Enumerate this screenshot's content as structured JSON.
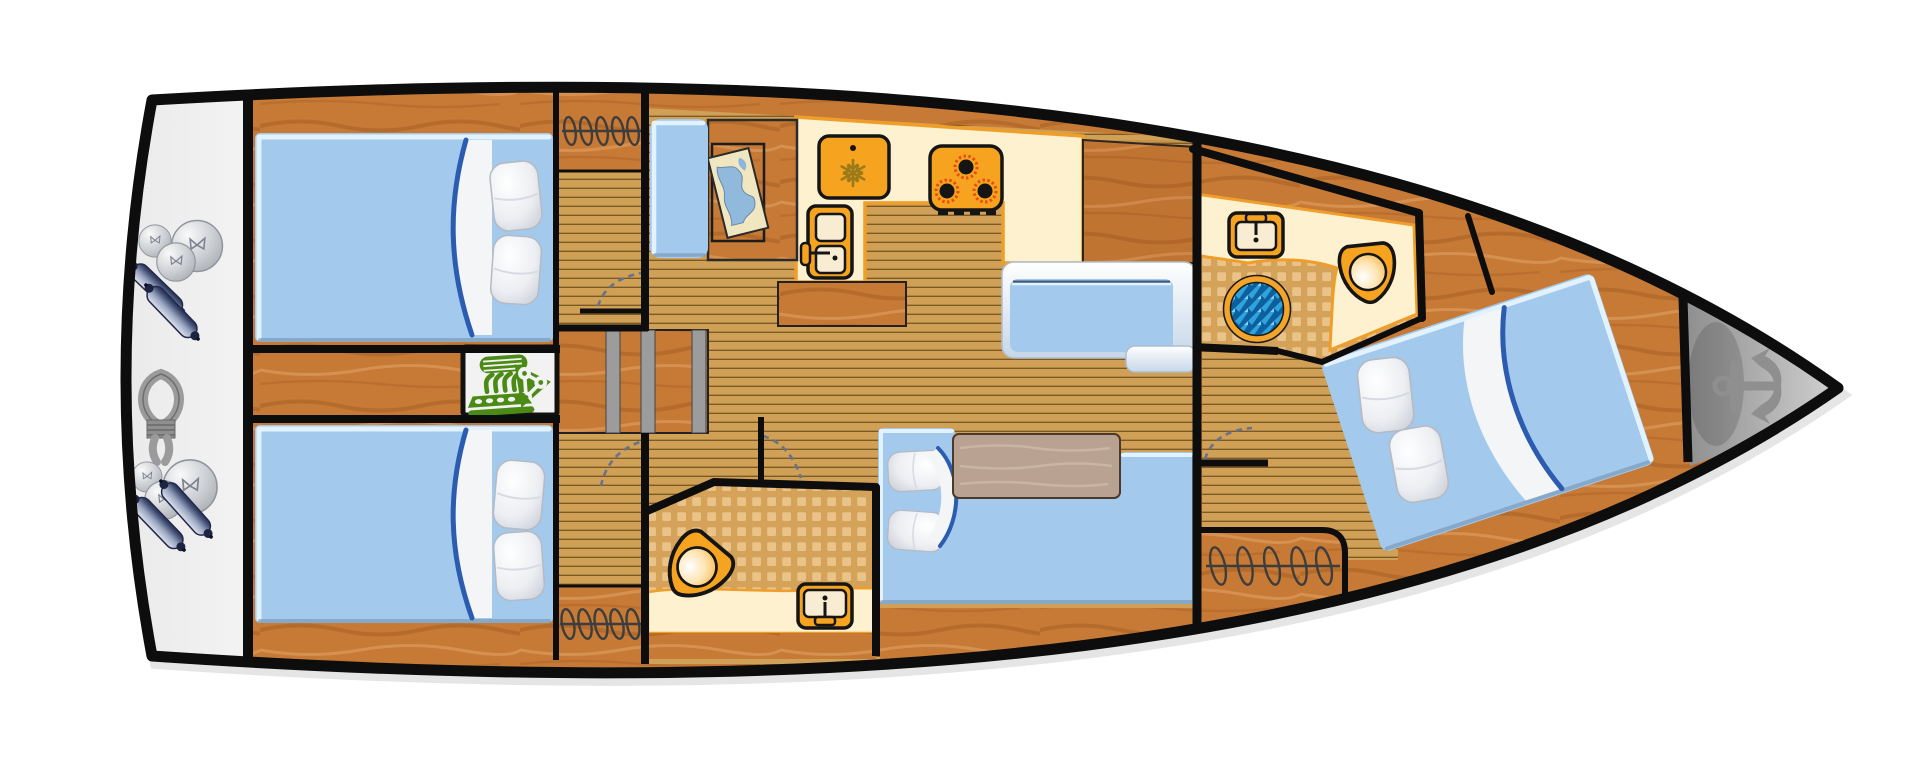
{
  "diagram": {
    "type": "yacht-interior-floor-plan",
    "title": "Sailing yacht interior layout — top-down deck plan, bow to the right",
    "orientation": "bow-right",
    "rooms": [
      {
        "id": "stern-platform",
        "label": "Stern swim platform / lazarette",
        "features": [
          "fender-balls",
          "cylindrical-fenders",
          "mooring-rope-coil"
        ]
      },
      {
        "id": "aft-cabin-port",
        "label": "Aft double cabin (top)",
        "features": [
          "double-berth",
          "two-pillows",
          "folded-blanket"
        ]
      },
      {
        "id": "aft-cabin-stbd",
        "label": "Aft double cabin (bottom)",
        "features": [
          "double-berth",
          "two-pillows",
          "folded-blanket"
        ]
      },
      {
        "id": "engine-room",
        "label": "Engine compartment between aft cabins",
        "features": [
          "engine"
        ]
      },
      {
        "id": "companionway",
        "label": "Companionway steps amidships",
        "features": [
          "three-treads"
        ]
      },
      {
        "id": "hanging-lockers",
        "label": "Hanging lockers (coil symbols)",
        "features": [
          "aft-top",
          "aft-bottom",
          "forward-cabin"
        ]
      },
      {
        "id": "nav-station",
        "label": "Navigation station",
        "features": [
          "navigator-seat",
          "chart-table",
          "sea-chart"
        ]
      },
      {
        "id": "galley",
        "label": "Galley (L-shaped counter)",
        "features": [
          "refrigerator",
          "three-burner-stove",
          "double-sink",
          "island-locker",
          "storage-cabinet"
        ]
      },
      {
        "id": "salon",
        "label": "Salon / dinette",
        "features": [
          "u-sofa",
          "wood-table",
          "bench-seat-with-white-trim",
          "seat-step",
          "two-cushions"
        ]
      },
      {
        "id": "aft-head",
        "label": "Aft head (WC)",
        "features": [
          "marine-toilet",
          "washbasin",
          "tiled-floor"
        ]
      },
      {
        "id": "forward-head",
        "label": "Forward head with shower",
        "features": [
          "marine-toilet",
          "washbasin",
          "shower-drain",
          "tiled-floor"
        ]
      },
      {
        "id": "forward-cabin",
        "label": "Forward owner cabin (angled island berth)",
        "features": [
          "double-berth",
          "two-pillows",
          "folded-blanket",
          "hanging-locker"
        ]
      },
      {
        "id": "anchor-locker",
        "label": "Bow anchor locker",
        "features": [
          "anchor"
        ]
      }
    ],
    "icons": [
      "anchor-icon",
      "engine-icon",
      "snowflake-fridge-icon",
      "stove-burners-icon",
      "galley-sink-icon",
      "washbasin-icon",
      "toilet-icon",
      "shower-drain-icon",
      "chart-map-icon",
      "fender-ball-icon",
      "fender-cylinder-icon",
      "mooring-rope-icon",
      "hanging-locker-coil-icon",
      "door-swing-arc",
      "companionway-steps"
    ],
    "colors": {
      "hullOutline": "#0d0d0d",
      "wallBlack": "#0d0d0d",
      "deckWood": "#c67a35",
      "deckGrainDark": "#a85f22",
      "deckGrainLight": "#da9757",
      "plankFloor": "#cfa055",
      "plankLine": "#7c5a26",
      "tileBase": "#d4a258",
      "tileLight": "#ecc68c",
      "counterCream": "#fdf1d0",
      "creamEdgeOrange": "#ef9e2a",
      "applianceOrange": "#f6a41f",
      "iconOutline": "#151515",
      "bedBlue": "#a3c9ed",
      "bedHighlight": "#e2f2ff",
      "blanketEdgeBlue": "#2b5cb0",
      "upholsteryShadow": "#6f8cac",
      "tableWood": "#b9a291",
      "platformGray": "#ebebeb",
      "engineGreen": "#4a8a15",
      "showerRing": "#f2a52a",
      "showerBlueDark": "#0d5f9e",
      "showerBlueMid": "#2fa3dc",
      "showerBlueLight": "#7fd0f2",
      "bowGrayDark": "#8e8e8e",
      "bowGrayLight": "#ececec",
      "anchorGray": "#8f8f8f",
      "fenderNavy": "#3a476c",
      "fenderLight": "#dde3ee",
      "ballGray": "#c9ccd1",
      "ropeGray": "#9b9b9b",
      "doorArc": "#66738c",
      "snowflakeOlive": "#9c7a1a",
      "burnerRed": "#e84b0a"
    }
  }
}
